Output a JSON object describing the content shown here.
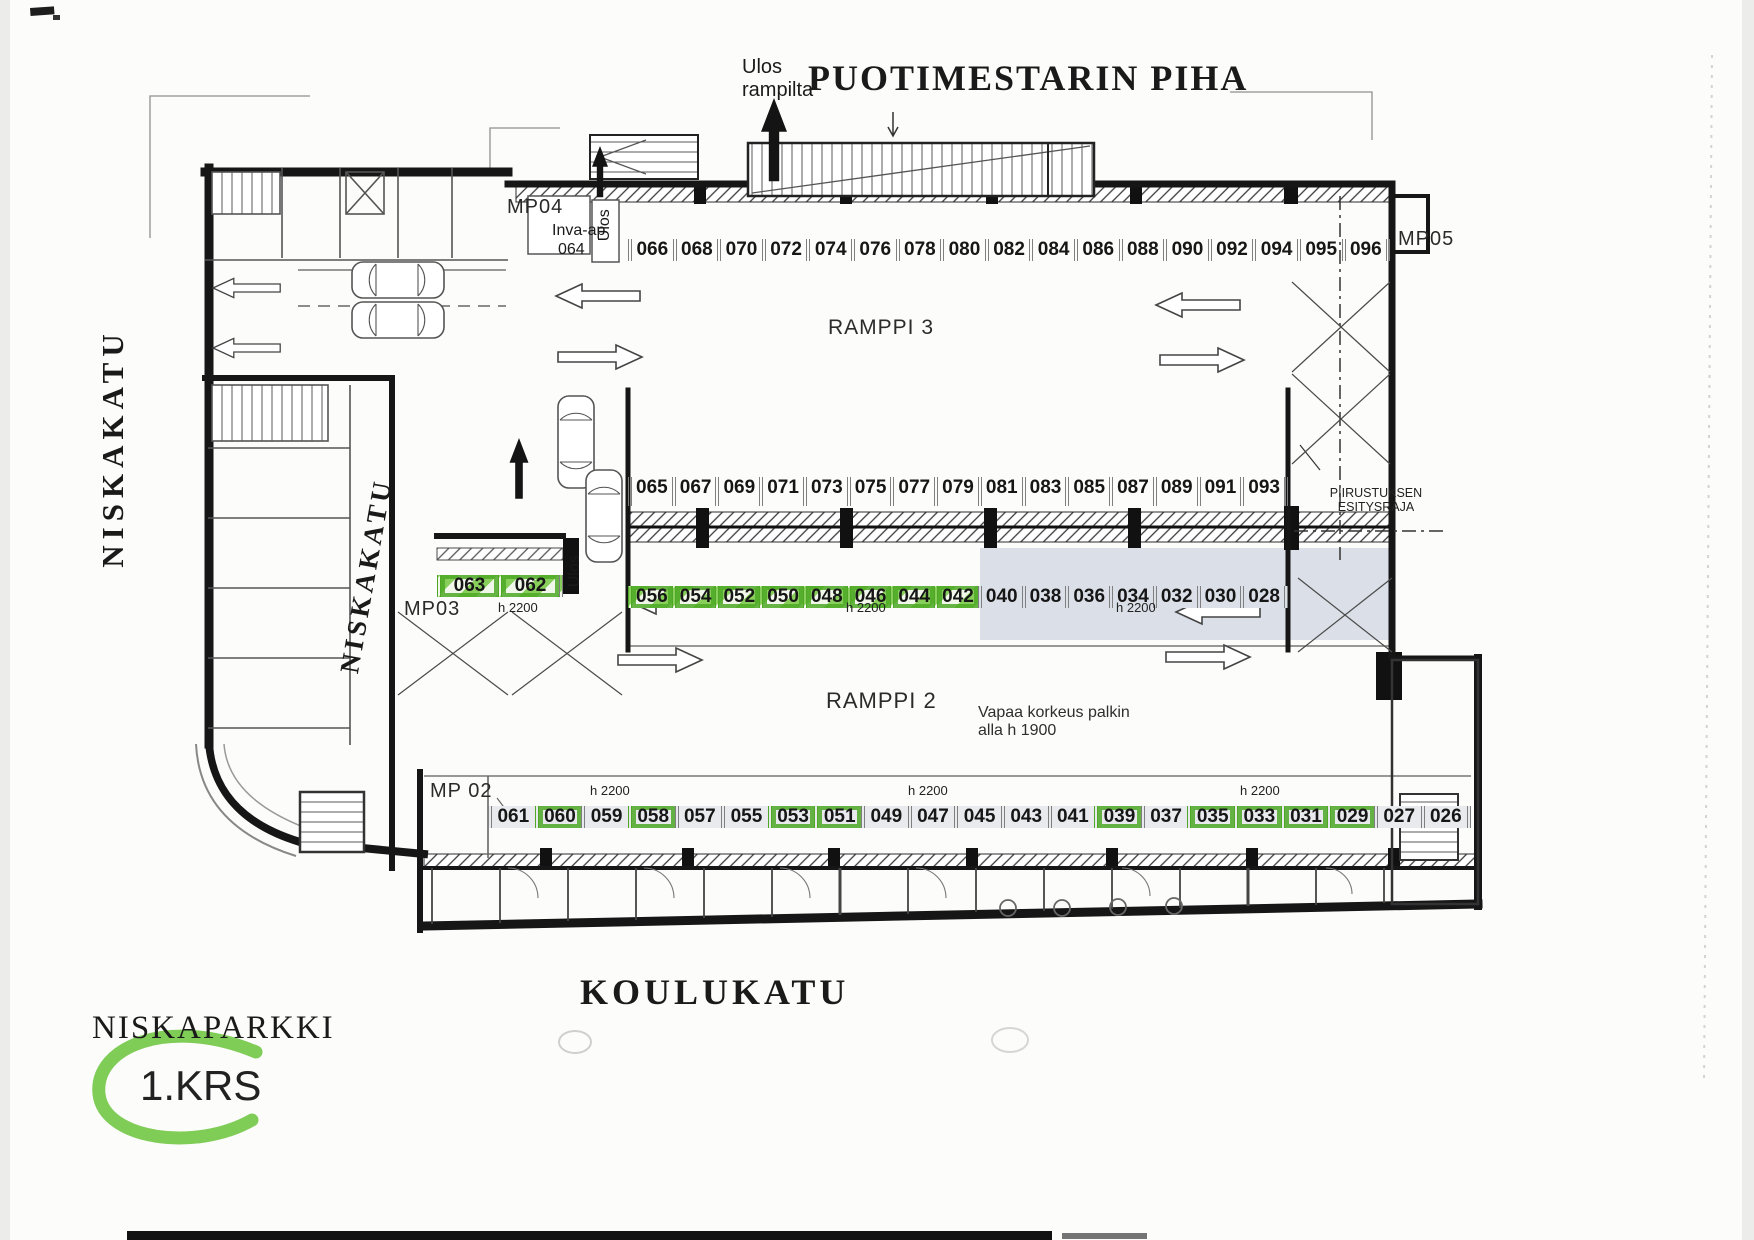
{
  "page": {
    "title": "PUOTIMESTARIN PIHA",
    "exit_note_line1": "Ulos",
    "exit_note_line2": "rampilta"
  },
  "streets": {
    "left": "NISKAKATU",
    "inner_diagonal": "NISKAKATU",
    "bottom": "KOULUKATU"
  },
  "logo": {
    "name": "NISKAPARKKI",
    "floor": "1.KRS"
  },
  "ramps": {
    "upper": "RAMPPI 3",
    "lower": "RAMPPI 2"
  },
  "boundary": {
    "line1": "PIIRUSTUKSEN",
    "line2": "ESITYSRAJA"
  },
  "clearance_note": {
    "line1": "Vapaa korkeus palkin",
    "line2": "alla  h 1900"
  },
  "entries": {
    "mp02": "MP 02",
    "mp03": "MP03",
    "mp04": "MP04",
    "mp05": "MP05",
    "ulos": "Ulos",
    "inva_label": "Inva-ap",
    "inva_number": "064"
  },
  "height_label": "h 2200",
  "rows": {
    "top": {
      "spots": [
        "066",
        "068",
        "070",
        "072",
        "074",
        "076",
        "078",
        "080",
        "082",
        "084",
        "086",
        "088",
        "090",
        "092",
        "094",
        "095",
        "096"
      ]
    },
    "middle": {
      "spots": [
        "065",
        "067",
        "069",
        "071",
        "073",
        "075",
        "077",
        "079",
        "081",
        "083",
        "085",
        "087",
        "089",
        "091",
        "093"
      ]
    },
    "third_left": {
      "spots": [
        "063",
        "062"
      ],
      "highlighted": [
        "063",
        "062"
      ]
    },
    "third": {
      "spots": [
        "056",
        "054",
        "052",
        "050",
        "048",
        "046",
        "044",
        "042",
        "040",
        "038",
        "036",
        "034",
        "032",
        "030",
        "028"
      ],
      "highlighted": [
        "056",
        "054",
        "052",
        "050",
        "048",
        "046",
        "044",
        "042"
      ],
      "shaded": [
        "040",
        "038",
        "036",
        "034",
        "032",
        "030",
        "028"
      ]
    },
    "bottom": {
      "spots": [
        "061",
        "060",
        "059",
        "058",
        "057",
        "055",
        "053",
        "051",
        "049",
        "047",
        "045",
        "043",
        "041",
        "039",
        "037",
        "035",
        "033",
        "031",
        "029",
        "027",
        "026"
      ],
      "highlighted": [
        "060",
        "058",
        "053",
        "051",
        "039",
        "035",
        "033",
        "031",
        "029"
      ]
    }
  },
  "colors": {
    "highlight_green": "#5ab42e",
    "shaded_band": "#dbe0e8",
    "wall": "#161616"
  }
}
